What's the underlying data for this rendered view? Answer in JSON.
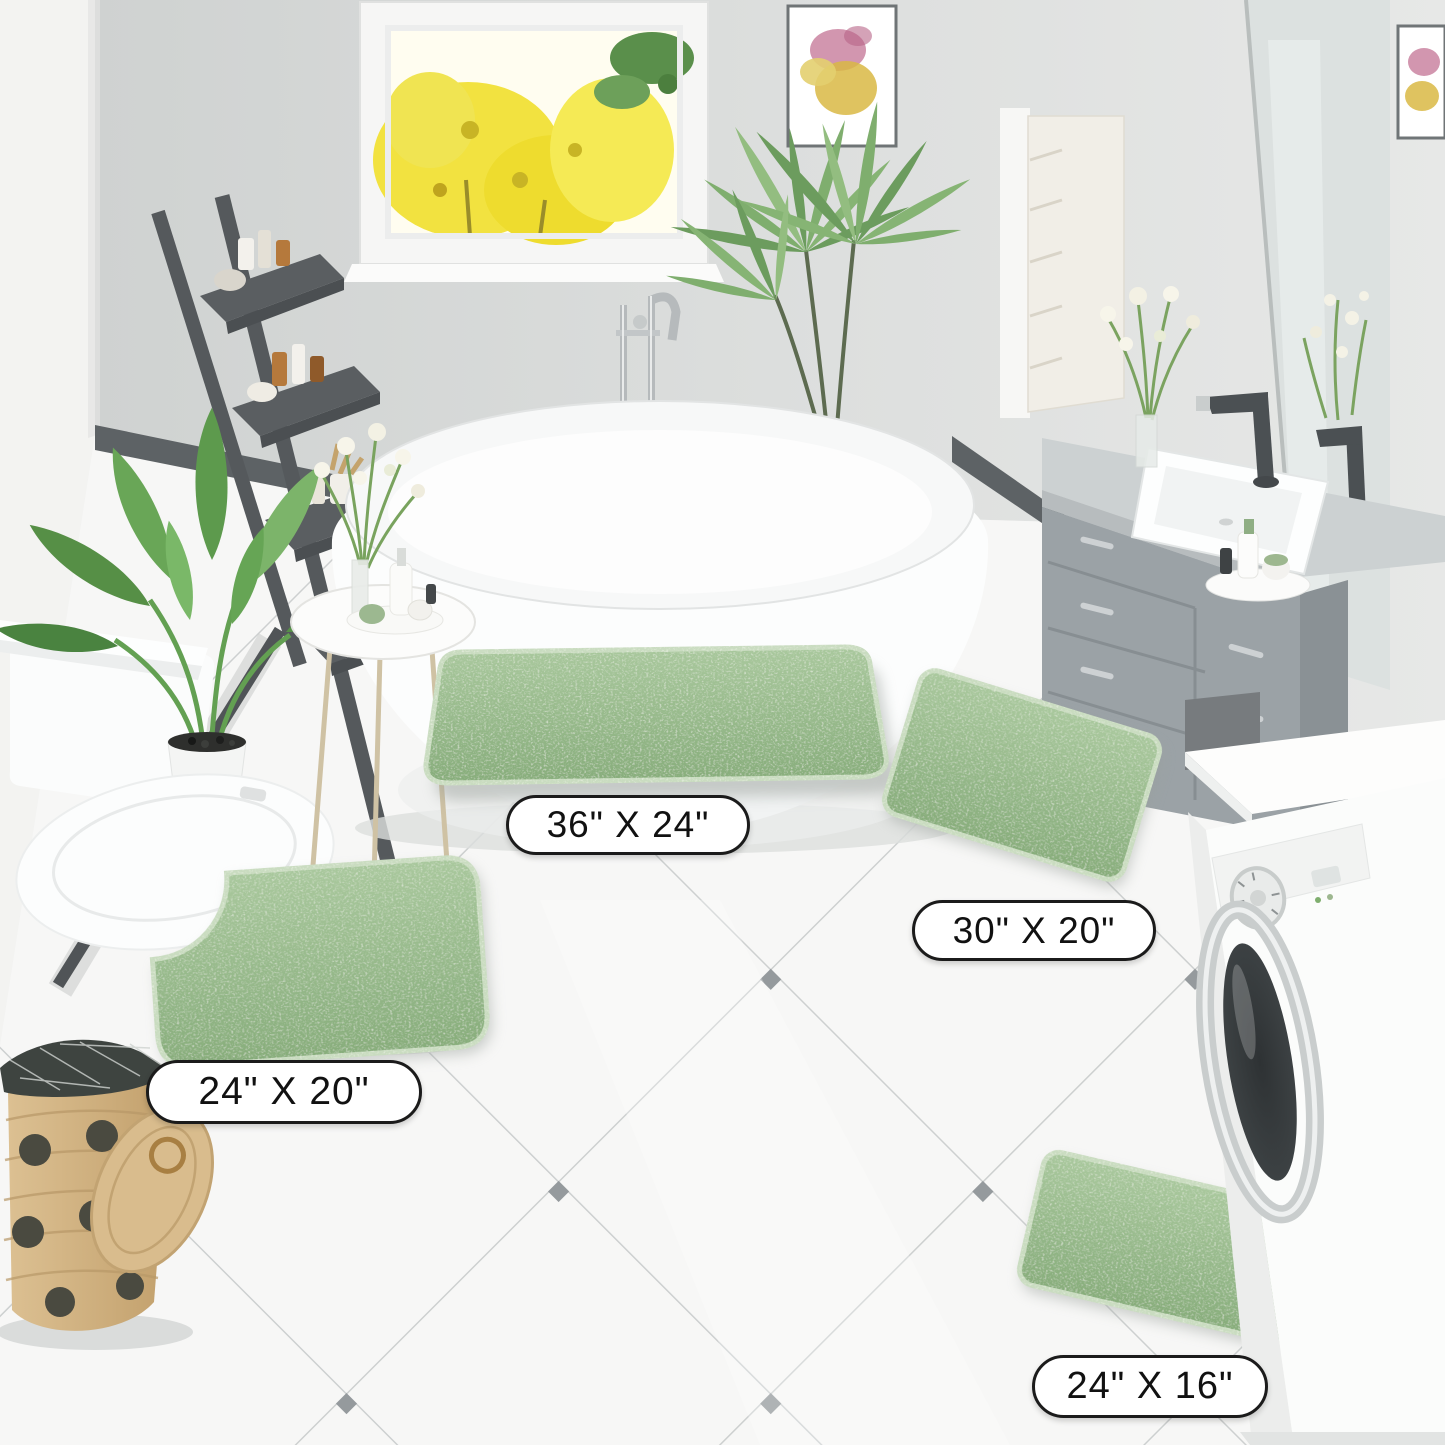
{
  "scene": {
    "description": "Bathroom product photo showing a 4-piece sage green chenille bath rug set"
  },
  "labels": {
    "rug_36x24": "36\" X 24\"",
    "rug_30x20": "30\" X 20\"",
    "rug_24x20_contour": "24\" X 20\"",
    "rug_24x16": "24\" X 16\""
  },
  "colors": {
    "rug_green": "#96ba8c",
    "rug_green_light": "#aecda4",
    "rug_green_dark": "#7fa577",
    "wall_back": "#d8dad9",
    "wall_left": "#f3f3f1",
    "baseboard_dark": "#5d6265",
    "floor_white": "#f7f7f6",
    "tile_grout": "#c6c9c9",
    "tile_diamond": "#848a8d",
    "vanity_gray": "#9ba2a6",
    "ladder_gray": "#55595c",
    "basket_tan": "#d3b384",
    "window_tree_yellow": "#f2e240",
    "label_background": "#ffffff",
    "label_border": "#1b1b1b",
    "label_text": "#111111"
  }
}
